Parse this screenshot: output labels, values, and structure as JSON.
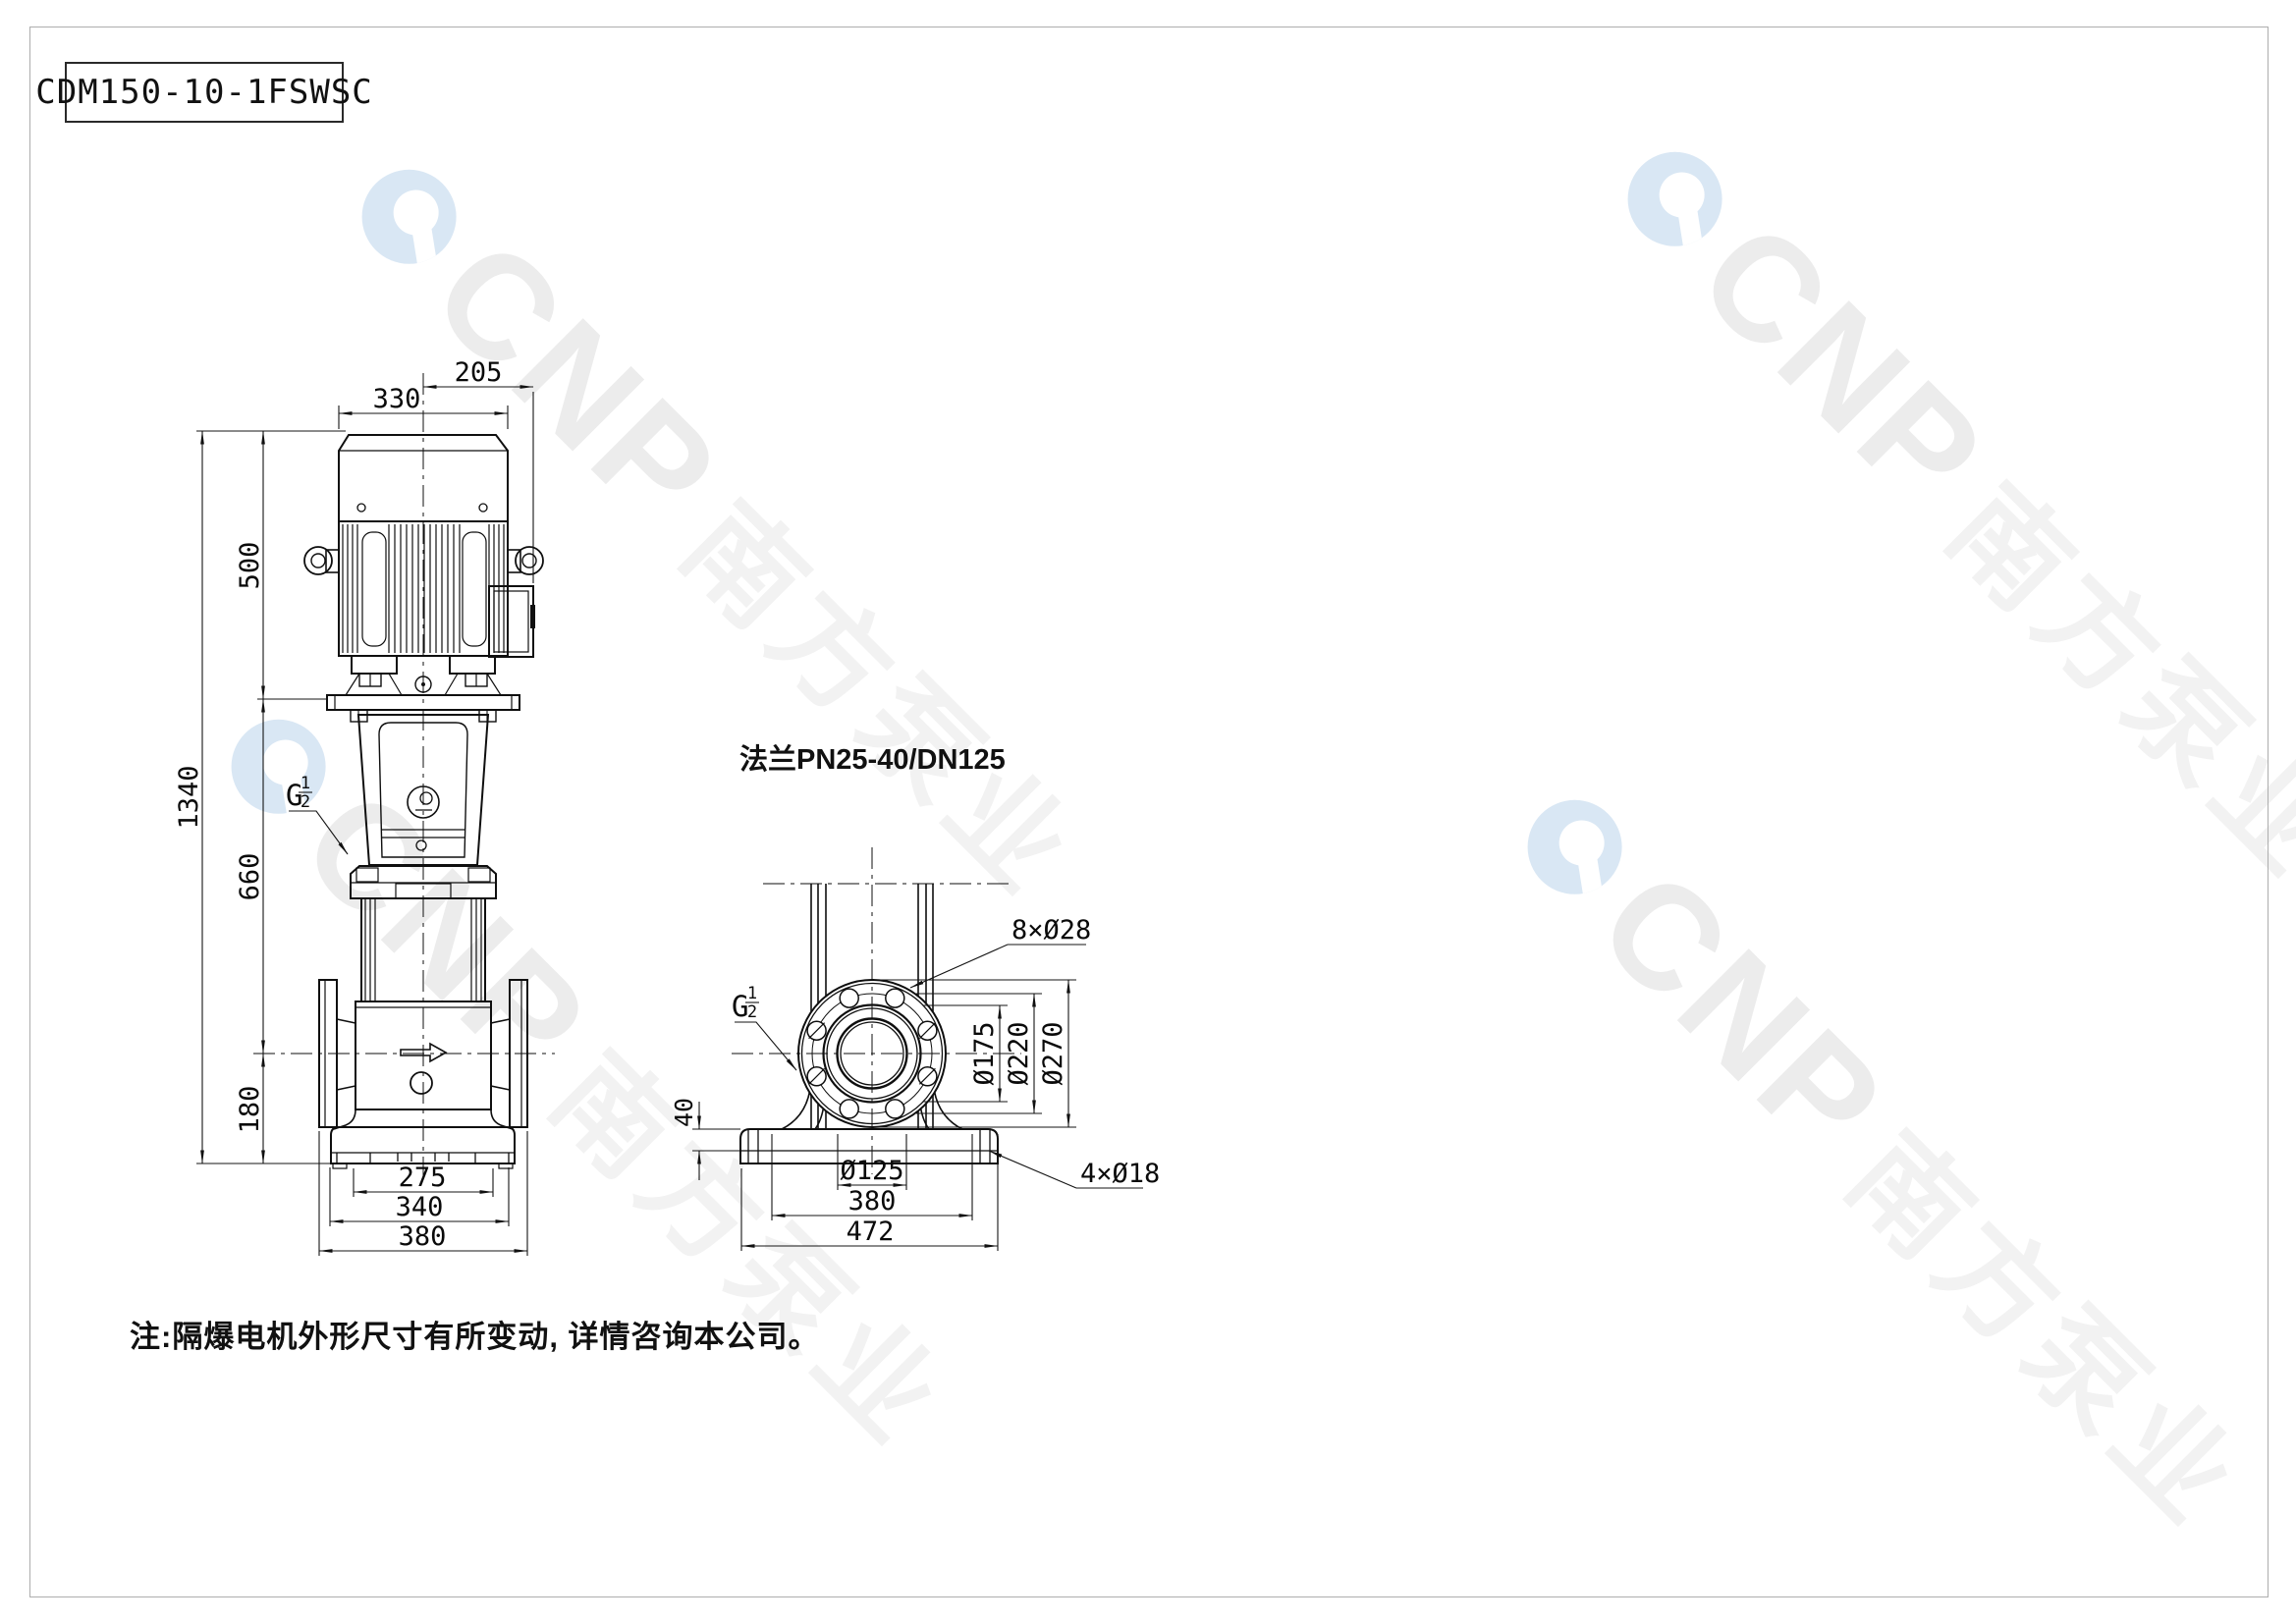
{
  "title_block": {
    "model": "CDM150-10-1FSWSC"
  },
  "labels": {
    "flange_spec": "法兰PN25-40/DN125",
    "note": "注:隔爆电机外形尺寸有所变动, 详情咨询本公司。"
  },
  "watermark": {
    "brand": "CNP",
    "brand_cn": "南方泵业",
    "logo_color": "#d9e7f4",
    "brand_color": "#ececec",
    "brand_cn_color": "#f2f2f2"
  },
  "front_view": {
    "dims": {
      "motor_width": "330",
      "terminal_offset": "205",
      "motor_height": "500",
      "total_height": "1340",
      "mid_height": "660",
      "port_height": "180",
      "feet_bolt_span": "275",
      "base_width": "340",
      "flange_span": "380"
    },
    "thread": {
      "g": "G",
      "num": "1",
      "den": "2"
    }
  },
  "side_view": {
    "dims": {
      "flange_bolt_holes": "8×Ø28",
      "raised_face_dia": "Ø175",
      "bolt_circle_dia": "Ø220",
      "flange_outer_dia": "Ø270",
      "base_plate_height": "40",
      "bore_dia": "Ø125",
      "base_bolt_span": "380",
      "base_length": "472",
      "base_holes": "4×Ø18"
    },
    "thread": {
      "g": "G",
      "num": "1",
      "den": "2"
    }
  }
}
